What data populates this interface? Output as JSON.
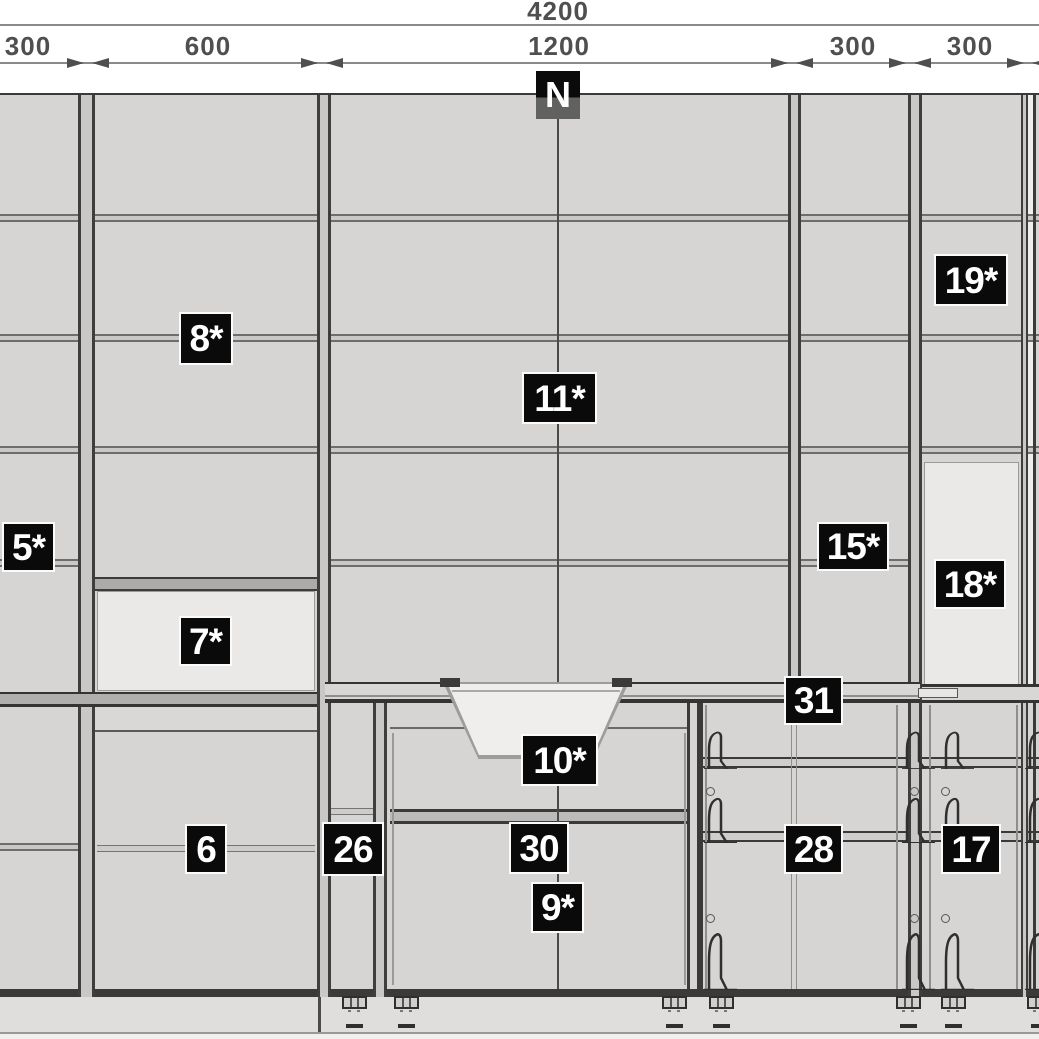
{
  "dimensions": {
    "overall": "4200",
    "segments": [
      "300",
      "600",
      "1200",
      "300",
      "300"
    ]
  },
  "north_marker": "N",
  "unit_labels": {
    "u5": "5*",
    "u6": "6",
    "u7": "7*",
    "u8": "8*",
    "u9": "9*",
    "u10": "10*",
    "u11": "11*",
    "u15": "15*",
    "u17": "17",
    "u18": "18*",
    "u19": "19*",
    "u26": "26",
    "u28": "28",
    "u30": "30",
    "u31": "31"
  },
  "colors": {
    "label_background": "#0a0a0a",
    "label_text": "#ffffff",
    "cabinet_fill": "#d6d5d3",
    "open_compartment_fill": "#eae9e7",
    "outline": "#3c3c3a",
    "dimension_text": "#4f4f4f"
  }
}
